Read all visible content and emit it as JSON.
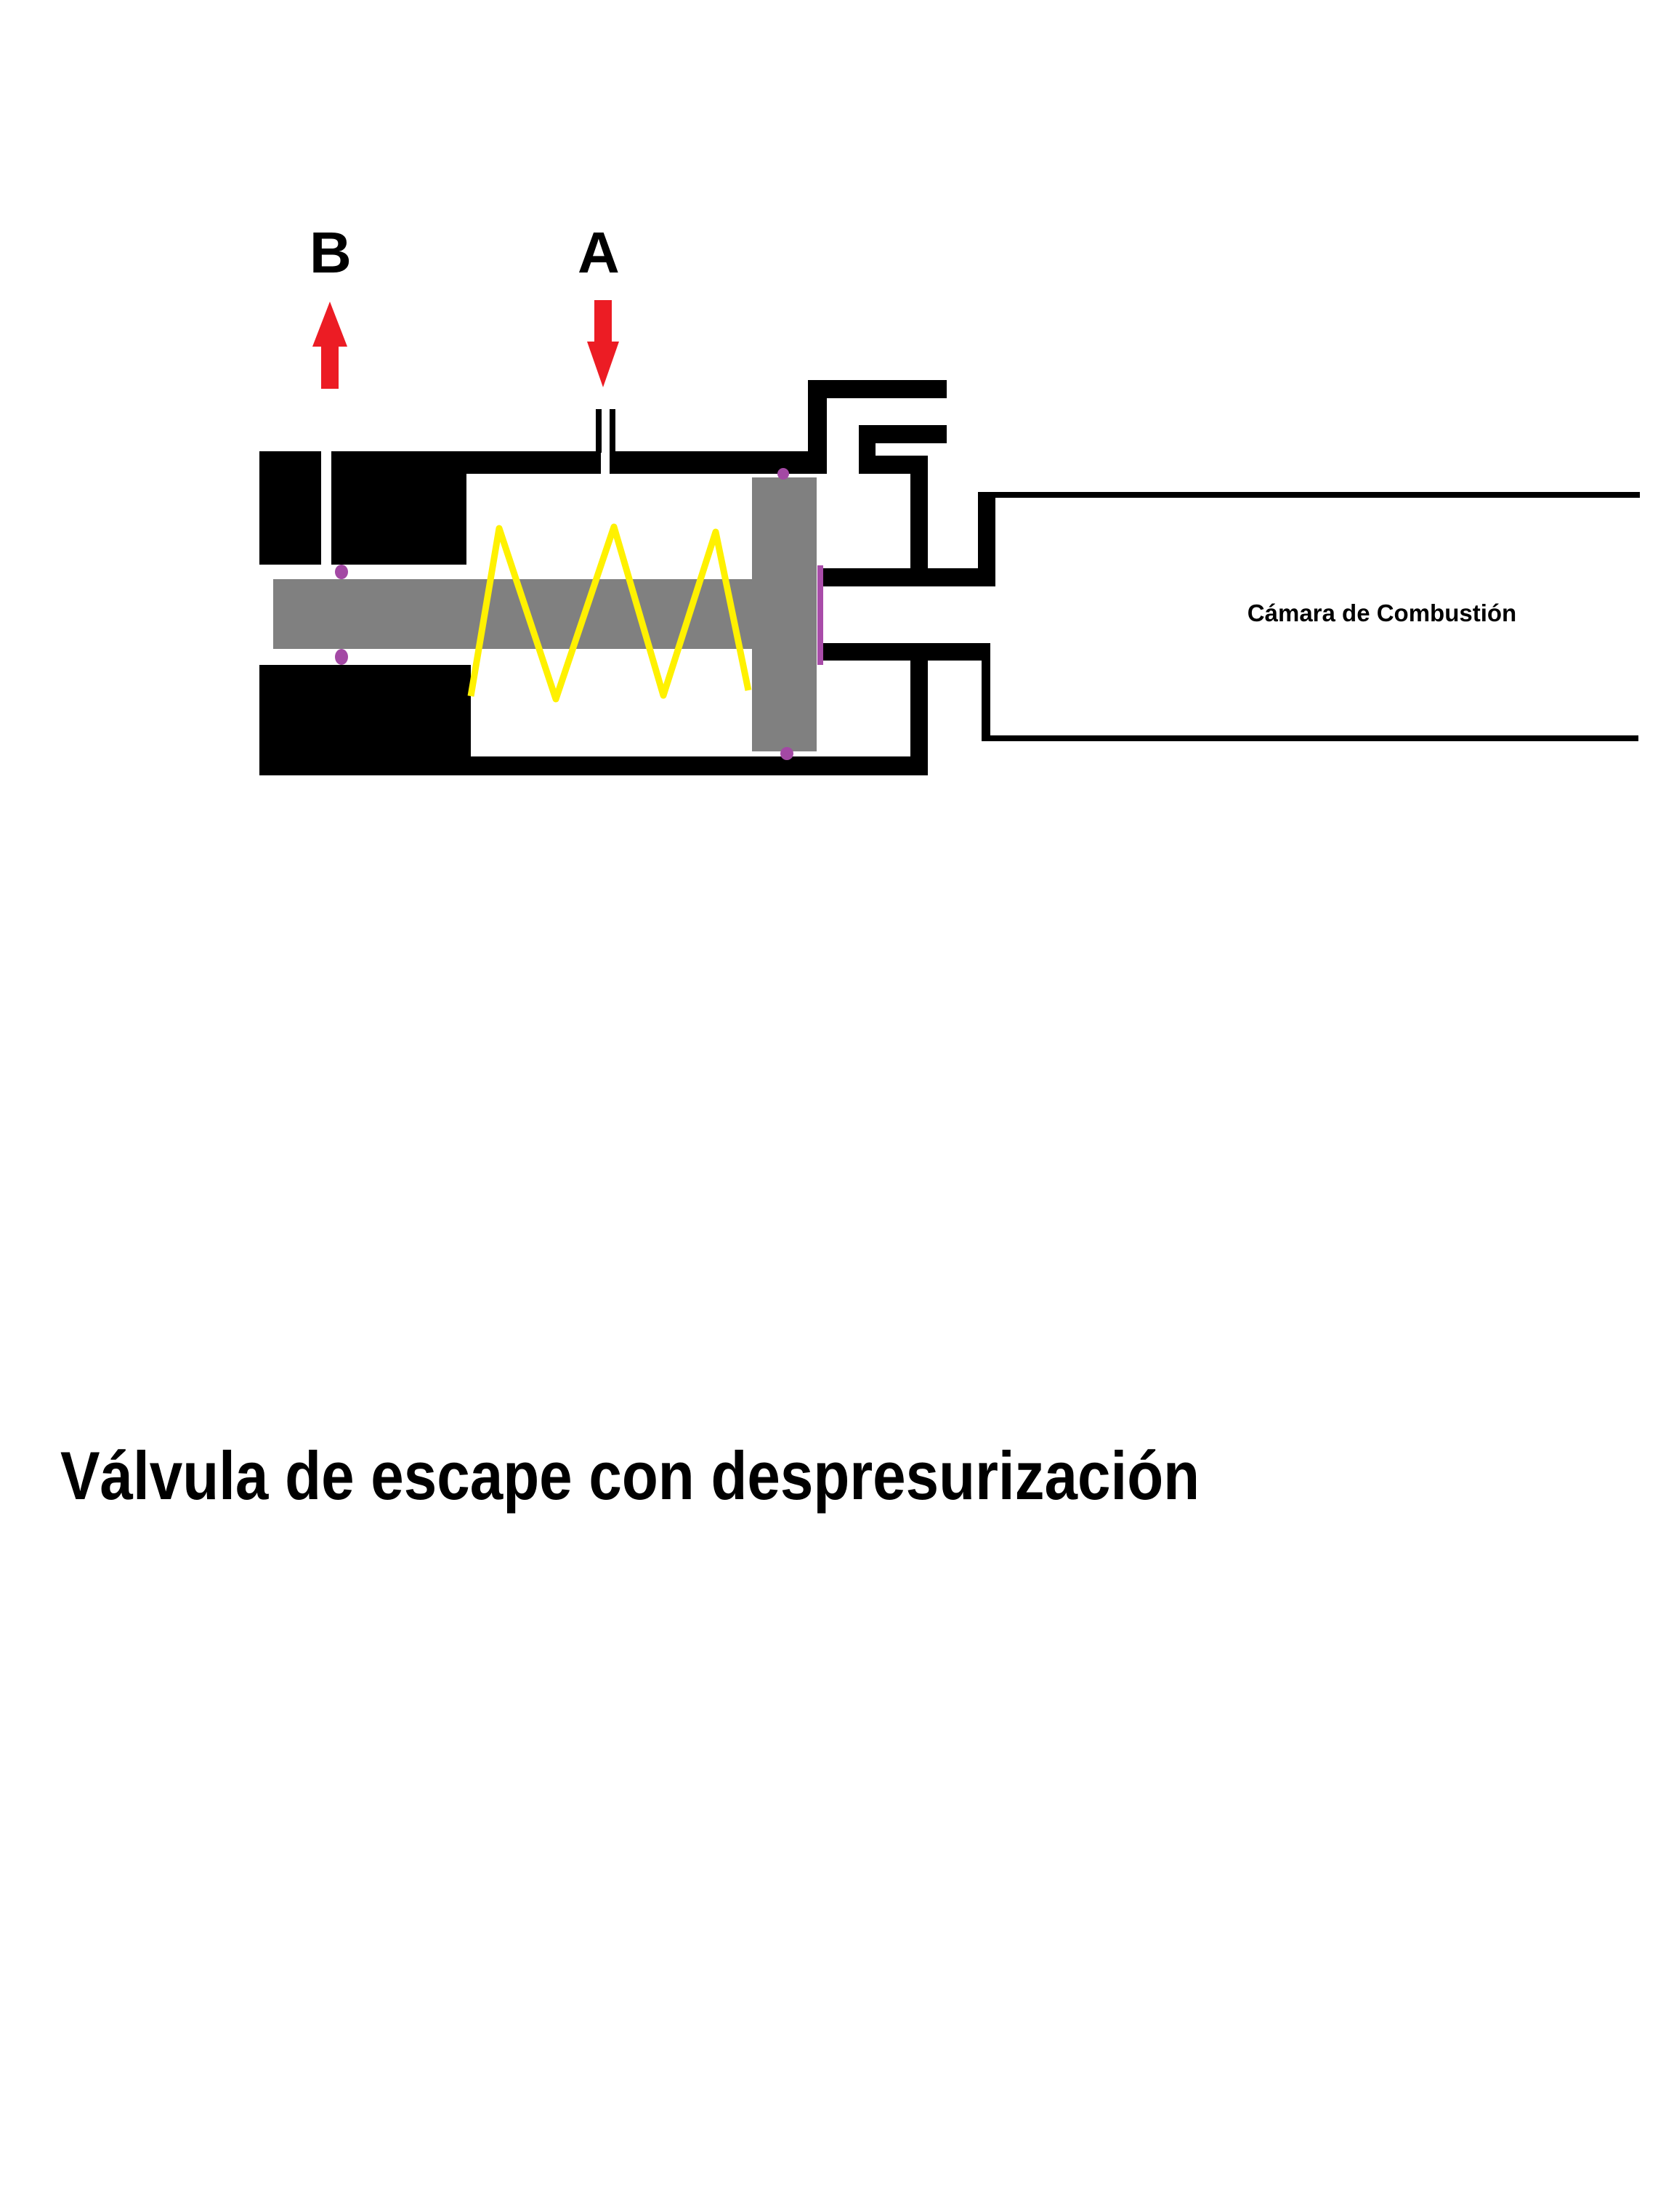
{
  "diagram": {
    "port_b_label": "B",
    "port_a_label": "A",
    "chamber_label": "Cámara de Combustión",
    "title": "Válvula de escape con despresurización"
  },
  "colors": {
    "background": "#FFFFFF",
    "body_black": "#000000",
    "piston_gray": "#808080",
    "spring_yellow": "#FFF100",
    "arrow_red": "#EC1C24",
    "seal_dot_purple": "#A349A4",
    "seal_line_purple": "#A94CA9"
  }
}
